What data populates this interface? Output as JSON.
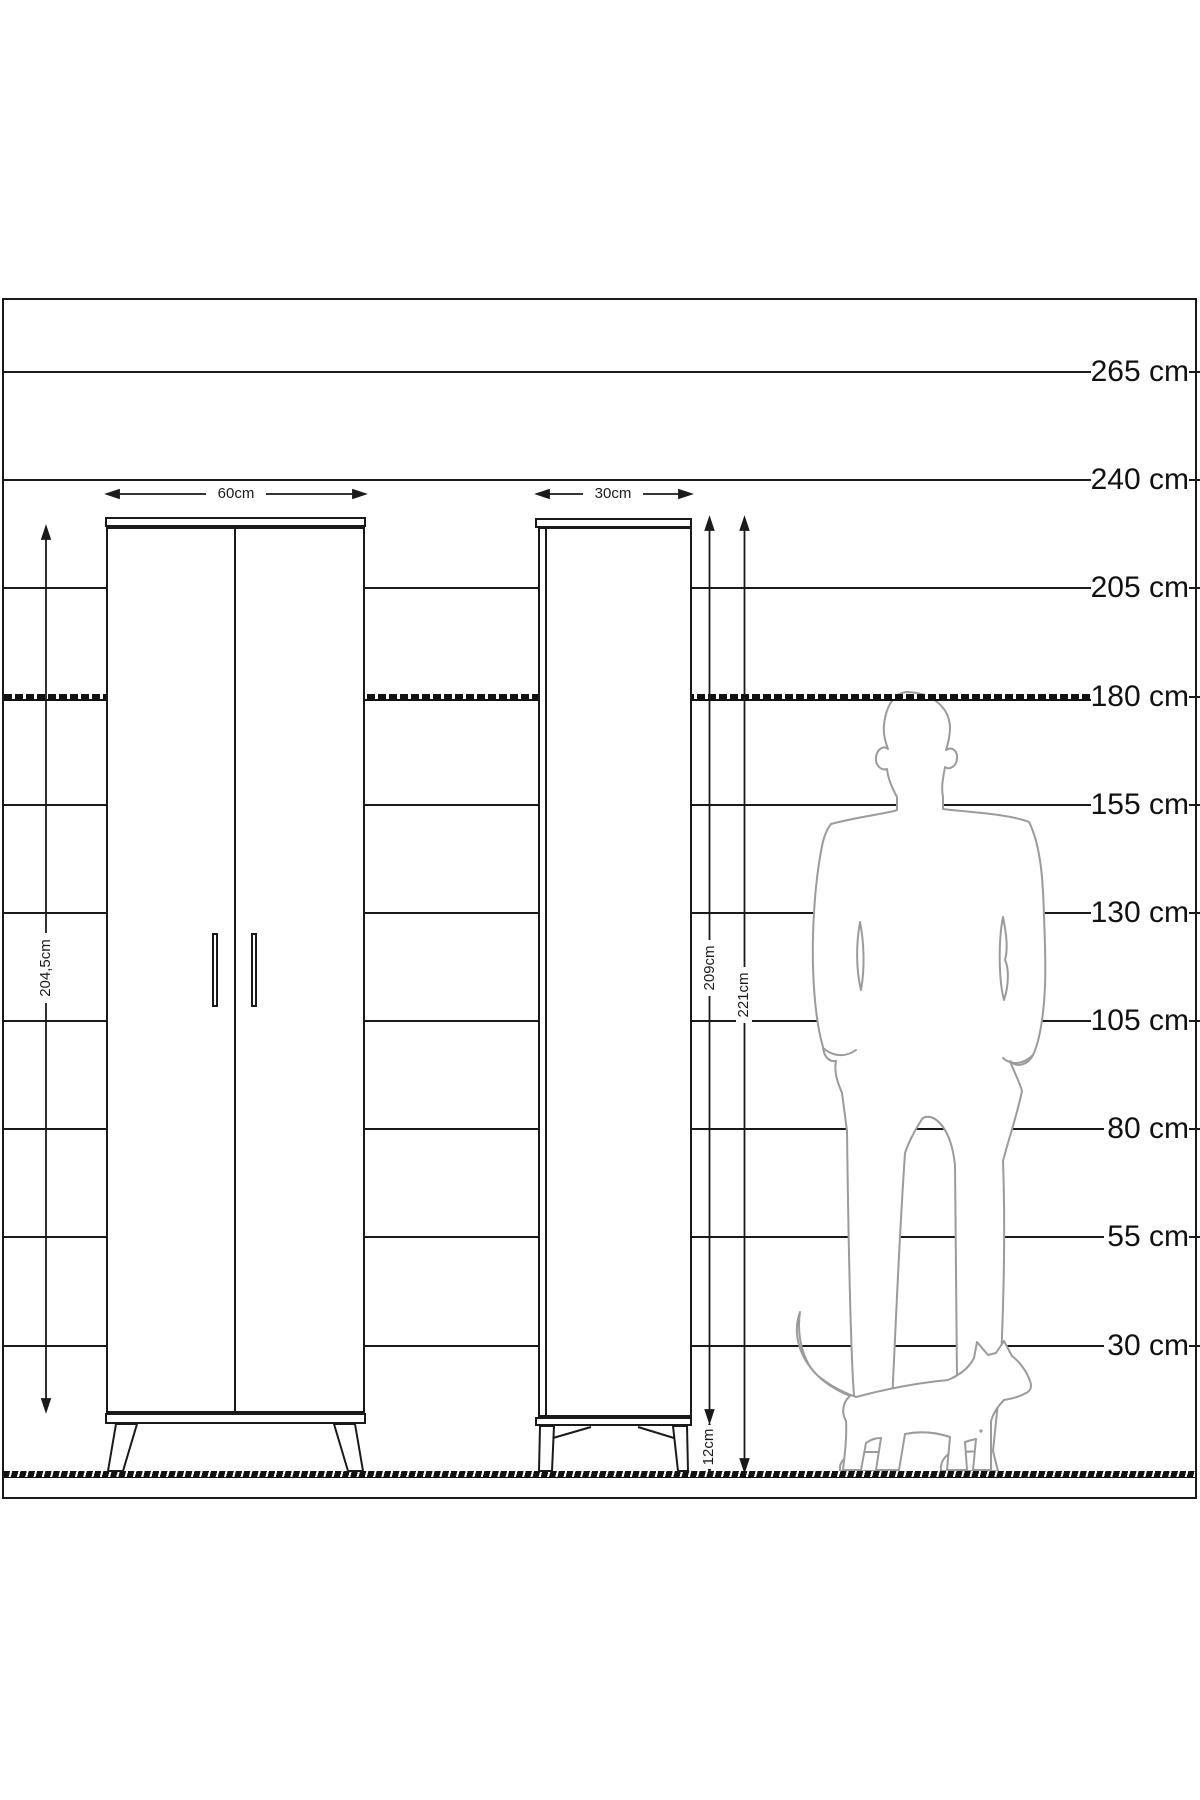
{
  "diagram": {
    "title_hidden": "",
    "scale_labels": [
      "265 cm",
      "240 cm",
      "205 cm",
      "180 cm",
      "155 cm",
      "130 cm",
      "105 cm",
      "80 cm",
      "55 cm",
      "30 cm"
    ],
    "dimensions": {
      "wardrobe_width": "60cm",
      "cabinet_width": "30cm",
      "wardrobe_height": "204,5cm",
      "cabinet_body_height": "209cm",
      "cabinet_total_height": "221cm",
      "cabinet_leg_height": "12cm"
    },
    "figures": {
      "man": "man-silhouette-180cm",
      "cat": "cat-silhouette"
    },
    "colors": {
      "line": "#1a1a1a",
      "figure_outline": "#9b9b9b",
      "background": "#ffffff"
    }
  }
}
